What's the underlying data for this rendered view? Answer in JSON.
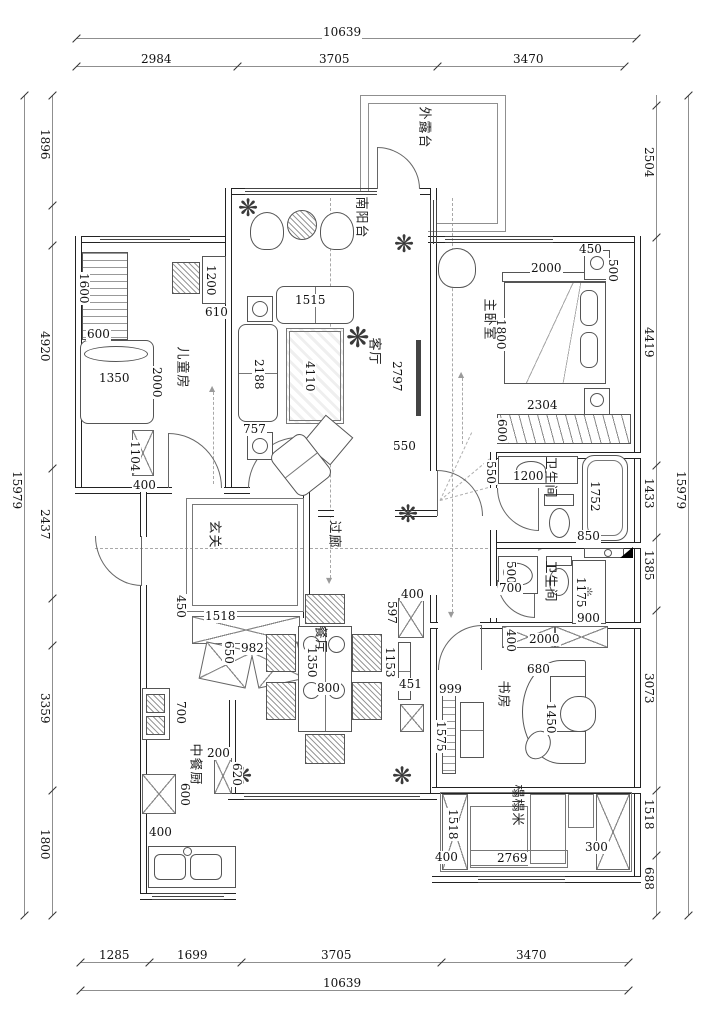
{
  "rooms": {
    "terrace": "外露台",
    "south_balcony": "南阳台",
    "kids": "儿童房",
    "living": "客厅",
    "master": "主卧室",
    "bath1": "卫生间",
    "bath2": "卫生间",
    "foyer": "玄关",
    "corridor": "过廊",
    "dining": "餐厅",
    "kitchen": "中餐厨",
    "study": "书房",
    "tatami": "榻榻米"
  },
  "dims": {
    "top": {
      "total": "10639",
      "segments": [
        "2984",
        "3705",
        "3470"
      ]
    },
    "bottom": {
      "total": "10639",
      "segments": [
        "1285",
        "1699",
        "3705",
        "3470"
      ]
    },
    "left": {
      "total": "15979",
      "segments": [
        "1896",
        "4920",
        "2437",
        "3359",
        "1800"
      ]
    },
    "right": {
      "total": "15979",
      "segments": [
        "2504",
        "4419",
        "1433",
        "1385",
        "3073",
        "1518",
        "688"
      ]
    },
    "kids": [
      "1600",
      "600",
      "1200",
      "610",
      "1350",
      "2000",
      "1104",
      "400"
    ],
    "living": [
      "1515",
      "2188",
      "4110",
      "757",
      "2797",
      "550"
    ],
    "master": [
      "450",
      "500",
      "2000",
      "1800",
      "2304",
      "600"
    ],
    "bath1": [
      "550",
      "1200",
      "1752",
      "850"
    ],
    "bath2": [
      "500",
      "700",
      "1175",
      "900"
    ],
    "foyer": [
      "450",
      "1518",
      "650",
      "982"
    ],
    "dining": [
      "1350",
      "800"
    ],
    "cabinet": [
      "400",
      "597",
      "1153",
      "451"
    ],
    "kitchen": [
      "700",
      "200",
      "620",
      "600",
      "400"
    ],
    "study": [
      "400",
      "2000",
      "680",
      "1450",
      "999",
      "1575"
    ],
    "tatami": [
      "1518",
      "400",
      "2769",
      "300"
    ]
  },
  "icons": {
    "plant": "❋",
    "shower": "❊",
    "arrow_down": "▼",
    "arrow_up": "▲",
    "arrow_right": "▶"
  },
  "colors": {
    "wall_line": "#222222",
    "furniture_line": "#555555",
    "dim_text": "#111111",
    "dash_line": "#a8a8a8"
  }
}
